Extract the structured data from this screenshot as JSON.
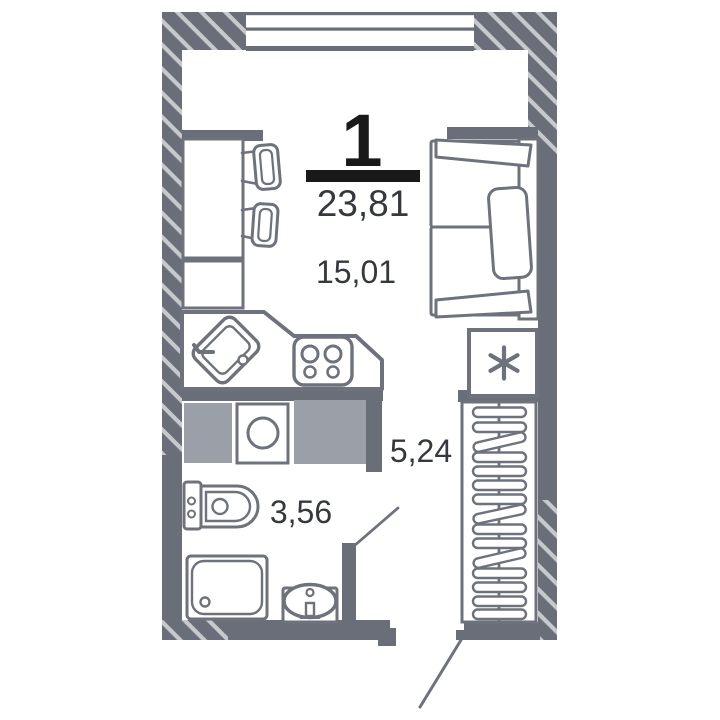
{
  "plan": {
    "apartment_number": "1",
    "total_area": "23,81",
    "areas": {
      "living": "15,01",
      "hallway": "5,24",
      "bathroom": "3,56"
    },
    "colors": {
      "wall": "#6a6e78",
      "hatch_stripe": "#c7c9cd",
      "furniture_outline": "#6d727c",
      "cabinet_fill": "#9ba0a8",
      "area_text": "#35383e",
      "number_text": "#191919",
      "background": "#ffffff"
    },
    "icons": {
      "fridge": "asterisk-snowflake-icon",
      "kitchen_sink": "sink-basin-icon",
      "stove": "four-burner-stove-icon",
      "washing_machine": "front-load-washer-icon",
      "toilet": "toilet-icon",
      "shower": "shower-tray-icon",
      "bathroom_sink": "washbasin-icon",
      "wardrobe": "hanger-rail-icon"
    }
  }
}
